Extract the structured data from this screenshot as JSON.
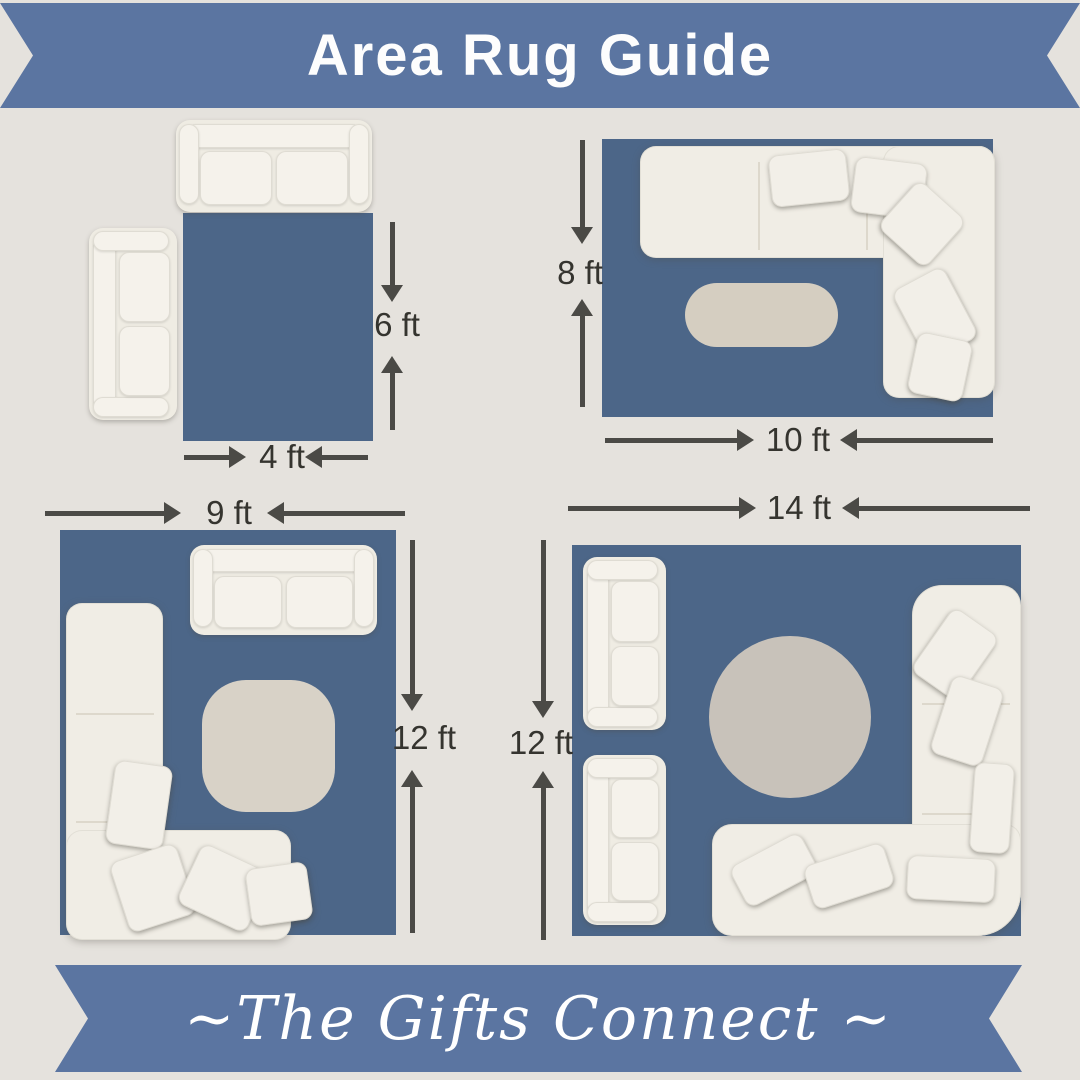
{
  "page": {
    "background": "#e5e2dd"
  },
  "header": {
    "title": "Area Rug Guide"
  },
  "footer": {
    "brand": "~The Gifts Connect ~"
  },
  "colors": {
    "banner_blue": "#5b75a1",
    "rug_blue": "#4c6688",
    "arrow_gray": "#4b4a46",
    "label_dark": "#35342f",
    "sofa_cream": "#f0ede5",
    "oval_table_beige": "#d5cec1",
    "square_table_beige": "#d8d2c7",
    "round_table_gray": "#c8c2ba"
  },
  "diagrams": [
    {
      "width_label": "4 ft",
      "height_label": "6 ft"
    },
    {
      "width_label": "10 ft",
      "height_label": "8 ft"
    },
    {
      "width_label": "9 ft",
      "height_label": "12 ft"
    },
    {
      "width_label": "14 ft",
      "height_label": "12 ft"
    }
  ]
}
